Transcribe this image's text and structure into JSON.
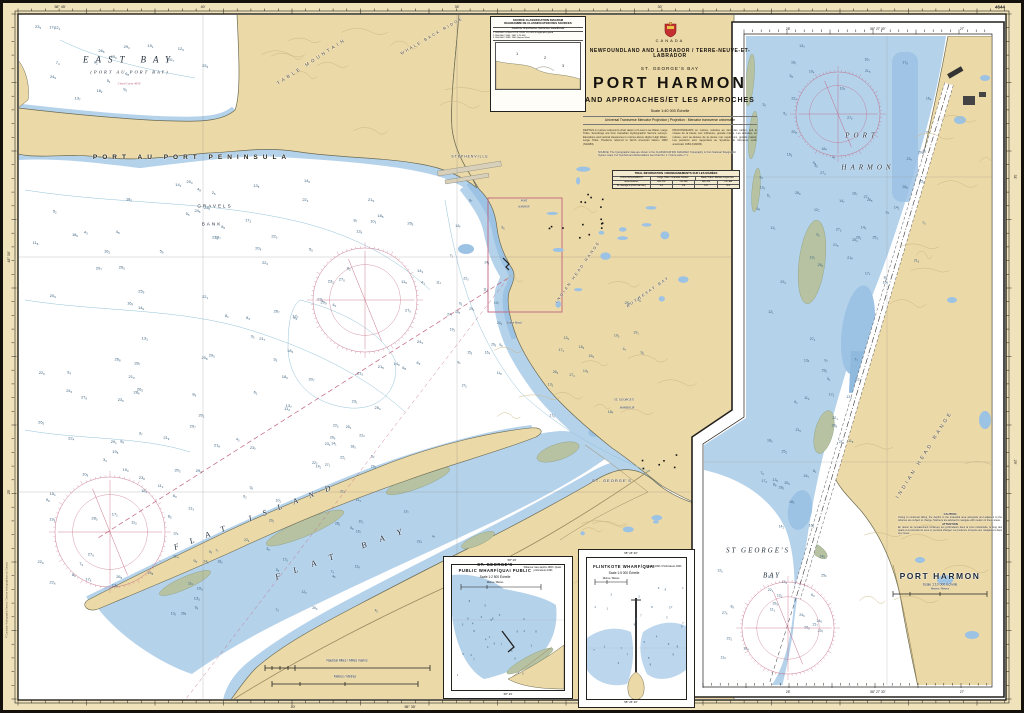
{
  "colors": {
    "land": "#ecd9a8",
    "shallow": "#b5d2eb",
    "mid_blue": "#9cc2e4",
    "deep": "#ffffff",
    "foreshore": "#b6c2a2",
    "magenta": "#b85f7c",
    "frame": "#23211c",
    "margin": "#f0e2ba"
  },
  "title_block": {
    "country": "CANADA",
    "region": "NEWFOUNDLAND AND LABRADOR / TERRE-NEUVE-ET-LABRADOR",
    "area": "ST. GEORGE'S BAY",
    "title": "PORT HARMON",
    "subtitle": "AND APPROACHES/ET LES APPROCHES",
    "scale": "Scale 1:40 000 Échelle",
    "projection": "Universal Transverse Mercator Projection | Projection : Mercator transverse universelle",
    "notes_left": "DEPTHS in metres reduced to chart datum of Lower Low Water, Large Tides. Soundings are from Canadian Hydrographic Service surveys. Elevations and vertical clearances in metres above Higher High Water, Large Tides. Positions referred to North American Datum 1983 (NAD83).",
    "notes_right": "PROFONDEURS en mètres, réduites au zéro des cartes, soit le niveau de la basse mer inférieure, grande marée. Les altitudes, en mètres, sont au-dessus de la pleine mer supérieure, grande marée. Les positions sont rapportées au Système de référence nord-américain 1983 (NAD83)."
  },
  "source_box": {
    "title_en": "SOURCE CLASSIFICATION DIAGRAM",
    "title_fr": "DIAGRAMME DE CLASSIFICATION DES SOURCES",
    "head": "Area/Zone   Ships/Navires   Year/Année   Scale/Échelle",
    "rows": [
      "1   CHS-SHC & Norcl   1979, 93-98   1:10 000 & larger/plus grand",
      "2   CHS-SHC   1942, 1967   1:20 000",
      "3   CHS-SHC   1899, 1903   Various/Varié"
    ]
  },
  "source_note": "SOURCE: The hydrographic data are shown in the CLASSIFICATION DIAGRAM. Topography is from National Topographic System maps. For Symbols and Abbreviations see Chart No. 1 / Voir la carte n° 1.",
  "tidal": {
    "title": "TIDAL INFORMATION / RENSEIGNEMENTS SUR LES MARÉES",
    "h_loc": "LOCATION ENDROIT",
    "h_large": "Large Tides / Grandes marées",
    "h_mean": "Mean Tides / Marées moyennes",
    "h_hw": "HW–PM",
    "h_lw": "LW–BM",
    "h_units": "metres/mètres",
    "row_name": "St. George's (Port Harmon)",
    "v1": "1.2",
    "v2": "0.2",
    "v3": "1.0",
    "v4": "0.4"
  },
  "labels": {
    "east_bay": "EAST BAY",
    "east_bay_sub": "(PORT AU PORT BAY)",
    "east_bay_ref": "Chart/Carte 4656",
    "peninsula": "PORT AU PORT PENINSULA",
    "gravels": "GRAVELS",
    "bank": "BANK",
    "table_mountain": "TABLE MOUNTAIN",
    "whale_back": "WHALE BACK RIDGE",
    "stephenville": "STEPHENVILLE",
    "rothesay": "ROTHESAY BAY",
    "indian_head": "INDIAN HEAD RANGE",
    "indian_head_pt": "Indian Head",
    "flat_island": "FLAT ISLAND",
    "flat_bay": "FLAT BAY",
    "st_georges": "ST. GEORGE'S",
    "harbour_a": "ST. GEORGE'S",
    "harbour_b": "HARBOUR",
    "port_sm": "PORT",
    "harmon_sm": "HARMON"
  },
  "panel": {
    "port": "PORT",
    "harmon": "HARMON",
    "st_georges": "ST GEORGE'S",
    "bay": "BAY",
    "indian_head_range": "INDIAN HEAD RANGE",
    "title": "PORT HARMON",
    "scale": "Scale 1:10 000 Échelle",
    "metres": "Metres / Mètres",
    "caution_en_head": "CAUTION",
    "caution_en": "Owing to continual silting, the depths in the industrial area alongside and adjacent to the wharves are subject to change. Mariners are advised to navigate with caution in these areas.",
    "caution_fr_head": "ATTENTION",
    "caution_fr": "En raison de l'envasement continuel, les profondeurs dans la zone industrielle, le long des quais et à proximité de ceux-ci, peuvent changer. La prudence s'impose aux navigateurs dans ces zones."
  },
  "inset_a": {
    "t1": "ST. GEORGE'S",
    "t2": "PUBLIC WHARF/QUAI PUBLIC",
    "scale": "Scale 1:2 500 Échelle",
    "metres": "Metres / Mètres",
    "note": "Wharves: face depths 1993 / Quais : profondeurs 1993",
    "coord_top": "58° 29'",
    "coord_bottom": "58° 29'"
  },
  "inset_b": {
    "t": "FLINTKOTE WHARF/QUAI",
    "scale": "Scale 1:5 000 Échelle",
    "metres": "Metres / Mètres",
    "note": "Depths 1993 / Profondeurs 1993",
    "coord_top": "58° 26' 30\"",
    "coord_bottom": "58° 26' 30\""
  },
  "scalebars": {
    "miles": "Nautical Miles / Milles marins",
    "metres": "Metres / Mètres"
  },
  "grat": {
    "t1": "58° 45'",
    "t2": "40'",
    "t3": "35'",
    "t4": "30'",
    "b1": "40'",
    "b2": "58° 35'",
    "l1": "48° 30'",
    "l2": "25'",
    "r1": "31'",
    "r2": "29'",
    "pt1": "28'",
    "pt2": "58° 27' 30\"",
    "pt3": "27'",
    "pb1": "28'",
    "pb2": "58° 27' 30\"",
    "pb3": "27'"
  },
  "corner": {
    "num": "4644",
    "edge": "© Canadian Hydrographic Service / Service hydrographique du Canada"
  }
}
